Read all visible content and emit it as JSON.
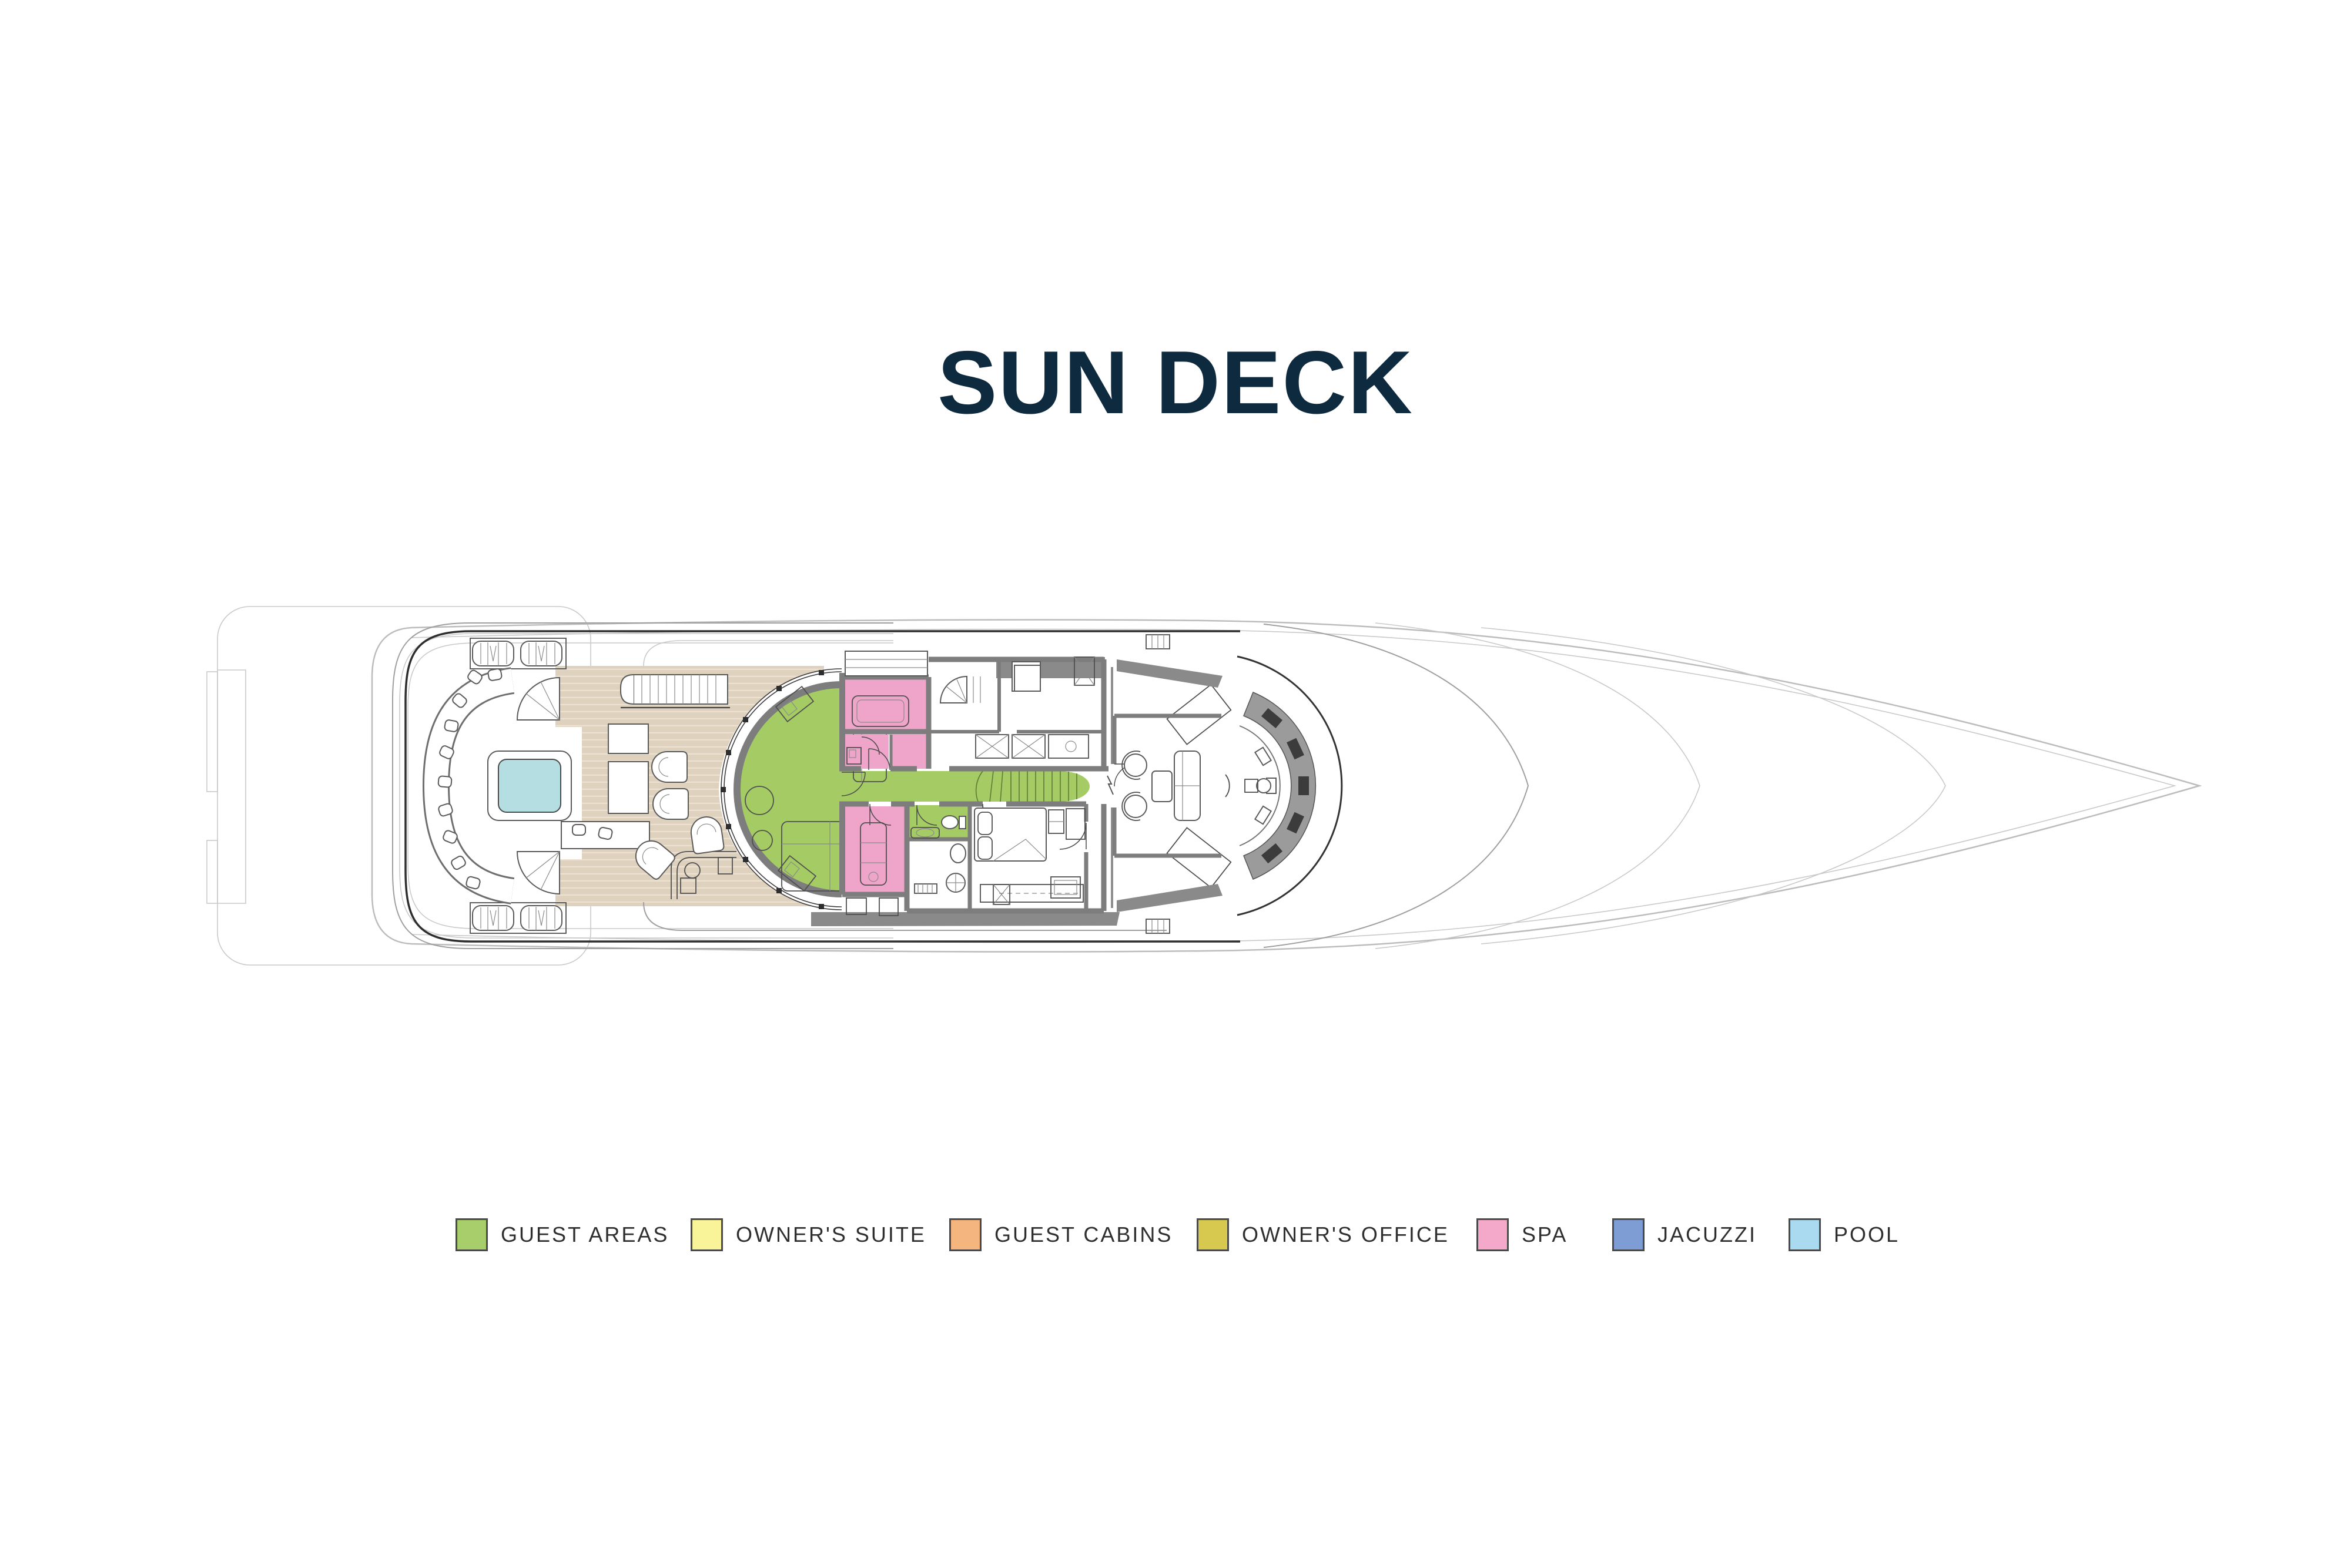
{
  "title": {
    "text": "SUN DECK",
    "color": "#0d2a3f"
  },
  "legend": {
    "swatch_border": "#4a4a4a",
    "label_color": "#2f2f2f",
    "items": [
      {
        "id": "guest-areas",
        "label": "GUEST AREAS",
        "color": "#a8ce6c"
      },
      {
        "id": "owners-suite",
        "label": "OWNER'S SUITE",
        "color": "#f9f49a"
      },
      {
        "id": "guest-cabins",
        "label": "GUEST CABINS",
        "color": "#f4b57f"
      },
      {
        "id": "owners-office",
        "label": "OWNER'S OFFICE",
        "color": "#d7c84f"
      },
      {
        "id": "spa",
        "label": "SPA",
        "color": "#f4a9ca"
      },
      {
        "id": "jacuzzi",
        "label": "JACUZZI",
        "color": "#7f9dd5"
      },
      {
        "id": "pool",
        "label": "POOL",
        "color": "#a9daf0"
      }
    ]
  },
  "plan": {
    "deck_name": "SUN DECK",
    "deck_color": "#ded1bd",
    "plank_line_color": "#ece1d2",
    "wall_color": "#7d7d7d",
    "hull_line_color": "#bcbcbc",
    "outline_color": "#2d2d2d",
    "highlight_colors": {
      "guest_areas": "#a5cc64",
      "spa": "#efa5c9",
      "pool_water": "#b5dee3"
    }
  }
}
